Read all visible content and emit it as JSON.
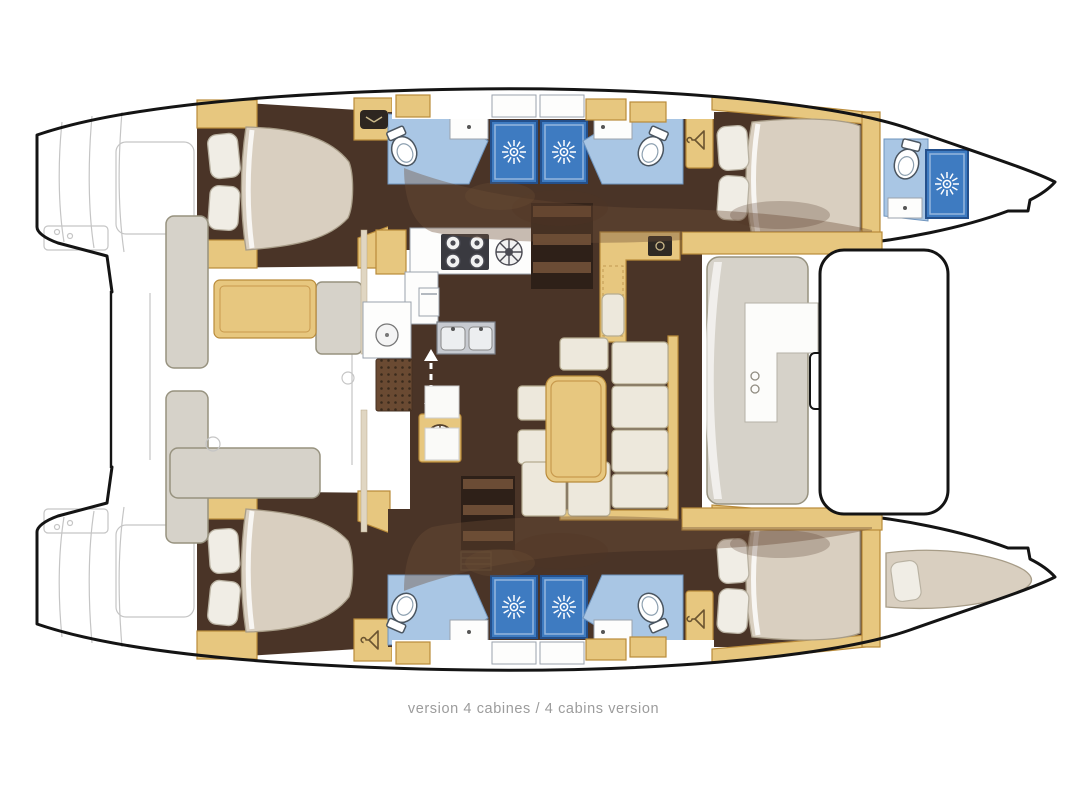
{
  "caption": "version 4 cabines / 4 cabins version",
  "colors": {
    "outline": "#141414",
    "wood": "#e7c77f",
    "wood-edge": "#b98b3a",
    "wood-light": "#f2e2b4",
    "floor": "#4a3427",
    "floor-dark": "#2e2018",
    "step-light": "#6b4c35",
    "mattress": "#d9cfc0",
    "mattress-edge": "#a79c87",
    "pillow": "#f0ede5",
    "pillow-edge": "#b9b2a2",
    "bath": "#a9c6e4",
    "bath-edge": "#6f94bd",
    "shower": "#3e7bc1",
    "shower-edge": "#24508c",
    "counter": "#fdfdfc",
    "counter-edge": "#9aa2ac",
    "sofa": "#ede8dc",
    "sofa-edge": "#b5ab90",
    "bench": "#d6d2c9",
    "bench-edge": "#97927f",
    "sketch": "#c5c5c5",
    "overlay": "#6e4f36",
    "overlay-dark": "#503525",
    "mat": "#6a4a32",
    "caption": "#9c9c9c"
  },
  "icons": {
    "shower-icon": "sunburst",
    "toilet-icon": "bowl-with-tank",
    "washbasin-icon": "counter-with-drain-dot",
    "wardrobe-icon": "clothes-hanger",
    "stove-icon": "four-burners-plus-round-burner",
    "sink-icon": "double-basin",
    "companionway-icon": "stairs",
    "sliding-door-icon": "double-headed-arrow",
    "helm-vent-icon": "spoked-wheel",
    "tv-vent-icon": "dark-hatch-chevron"
  }
}
